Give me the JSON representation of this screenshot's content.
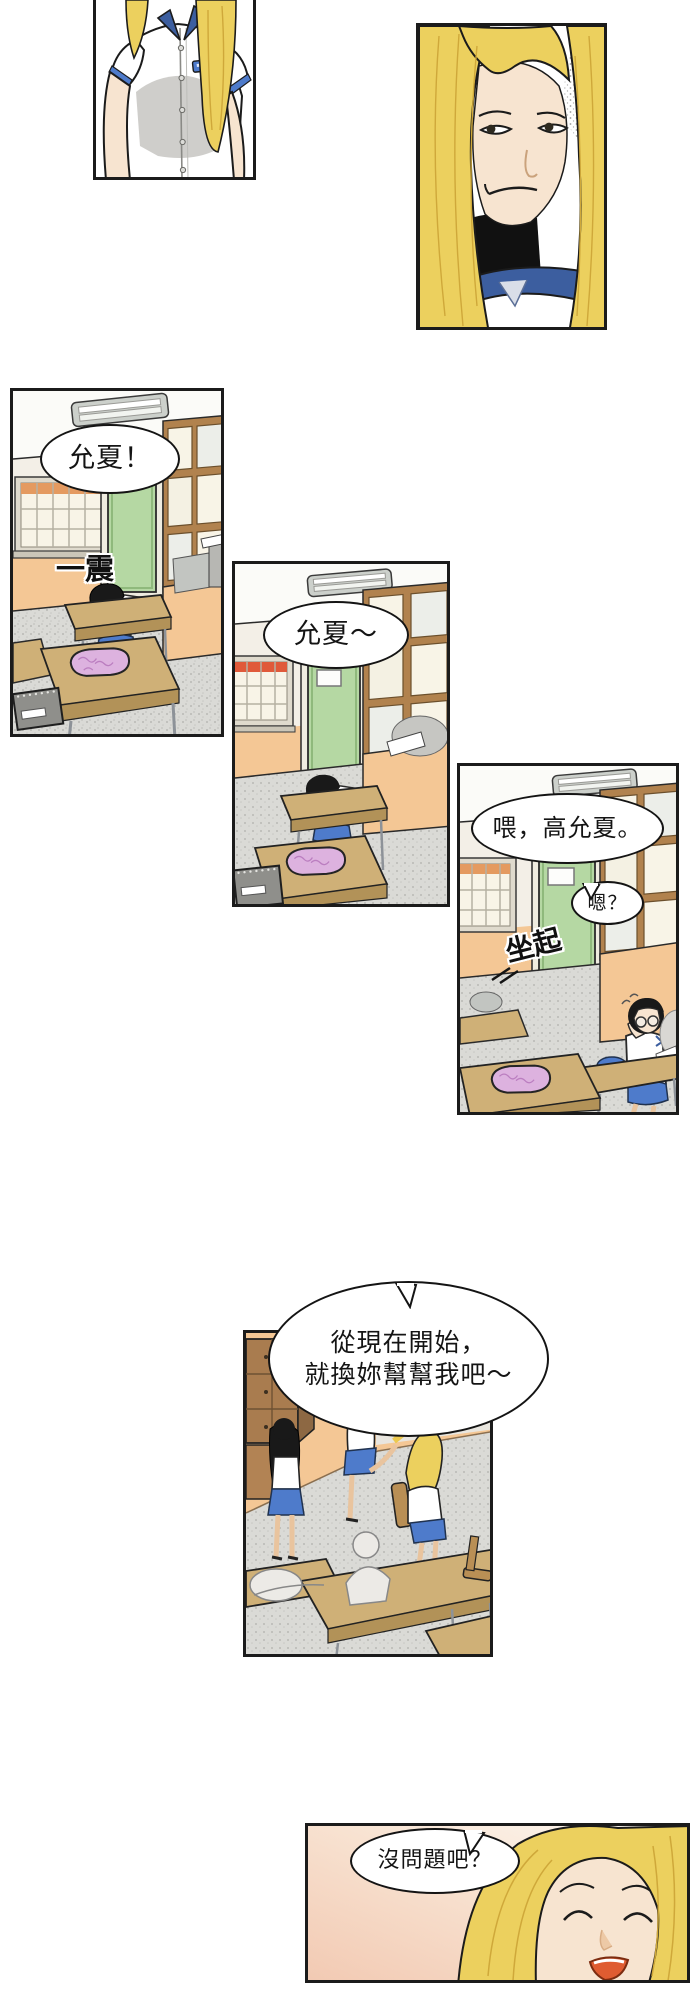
{
  "panels": {
    "panel1": {
      "alt": "schoolgirl uniform torso, head cropped"
    },
    "panel2": {
      "alt": "blonde girl smirking close-up"
    },
    "panel3": {
      "alt": "classroom, girl slumped asleep on desk"
    },
    "panel4": {
      "alt": "classroom wider view, girl still asleep"
    },
    "panel5": {
      "alt": "girl with glasses sits up rubbing eye"
    },
    "panel6": {
      "alt": "classroom with girls chatting by the window"
    },
    "panel7": {
      "alt": "blonde girl smiling with eyes closed"
    }
  },
  "speech": {
    "panel3": {
      "bubble": "允夏！",
      "sfx": "一震"
    },
    "panel4": {
      "bubble": "允夏～"
    },
    "panel5": {
      "call": "喂，高允夏。",
      "reply": "嗯？",
      "sfx": "坐起"
    },
    "panel6": {
      "line1": "從現在開始，",
      "line2": "就換妳幫幫我吧～"
    },
    "panel7": {
      "bubble": "沒問題吧？"
    }
  },
  "colors": {
    "outline": "#1b1b1b",
    "orange": "#f4c795",
    "wallLight": "#f3efe7",
    "ceiling": "#fbfbf8",
    "green": "#b5d8a3",
    "greenDark": "#8fb97c",
    "winBrown": "#b1824e",
    "cream": "#f8f4e7",
    "paneGray": "#eceee9",
    "floor": "#dadad6",
    "wood": "#cfb077",
    "woodDark": "#b29258",
    "metal": "#8d9298",
    "hairBlack": "#191919",
    "blonde": "#ecd05e",
    "blondeShade": "#cfa83a",
    "skin": "#f7e4d0",
    "skin2": "#e9c49e",
    "skirt": "#4e7bcb",
    "collar": "#3c5e9f",
    "pink": "#ddb2df",
    "pinkDark": "#bb7ec0",
    "locker": "#a97c4f",
    "lockerDark": "#8d6843",
    "sketch": "#eceae6",
    "bag": "#3d62aa",
    "juice": "#ecc94f",
    "mouth": "#df5c31",
    "gradWarm": "#f2c9b2",
    "gradPale": "#fdfaf5"
  }
}
